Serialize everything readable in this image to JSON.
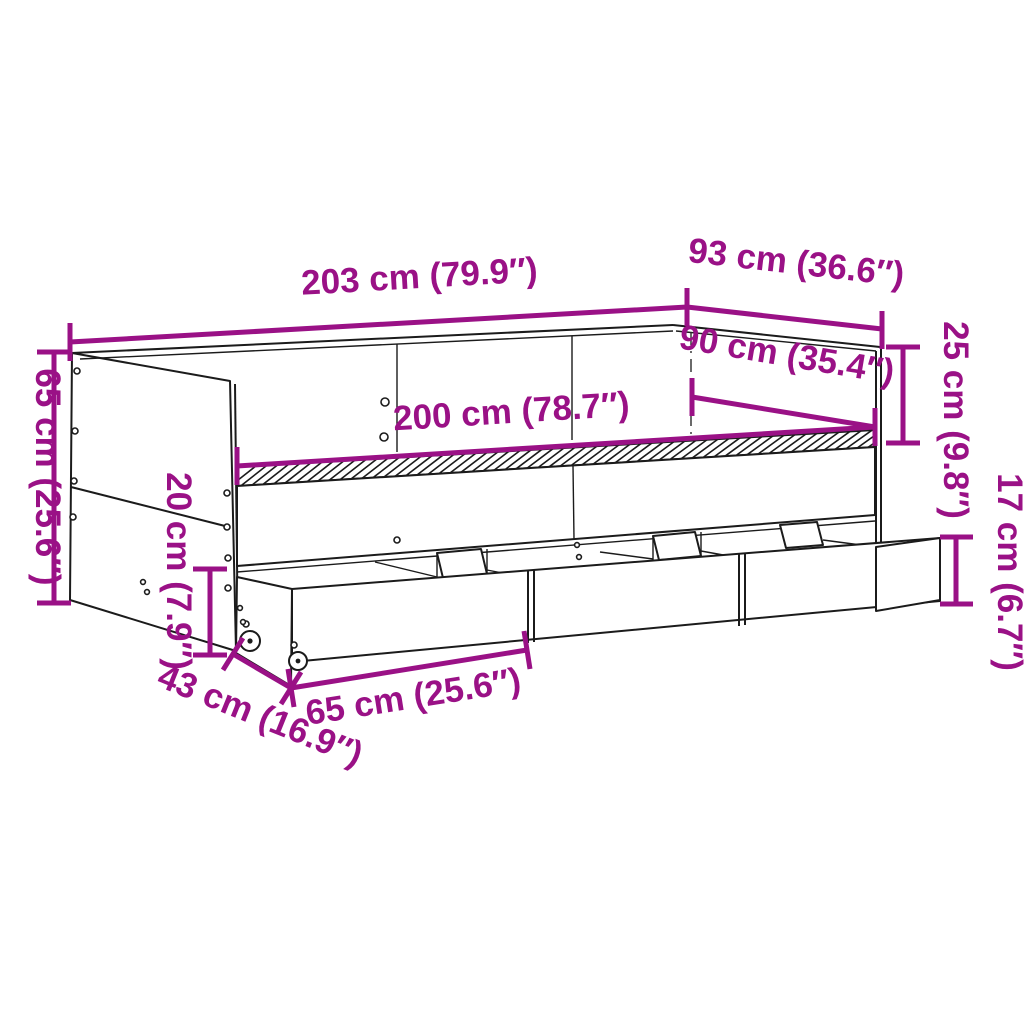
{
  "diagram": {
    "subject": "daybed-with-drawers-dimension-diagram",
    "colors": {
      "dimension_accent": "#9A1186",
      "line_art": "#1b1b1b",
      "background": "#ffffff"
    },
    "dimensions": [
      {
        "id": "overall-length",
        "label": "203 cm (79.9″)",
        "cm": 203,
        "inch": 79.9
      },
      {
        "id": "overall-depth",
        "label": "93 cm (36.6″)",
        "cm": 93,
        "inch": 36.6
      },
      {
        "id": "side-height",
        "label": "65 cm (25.6″)",
        "cm": 65,
        "inch": 25.6
      },
      {
        "id": "backrest-height",
        "label": "25 cm (9.8″)",
        "cm": 25,
        "inch": 9.8
      },
      {
        "id": "inner-width",
        "label": "90 cm (35.4″)",
        "cm": 90,
        "inch": 35.4
      },
      {
        "id": "inner-length",
        "label": "200 cm (78.7″)",
        "cm": 200,
        "inch": 78.7
      },
      {
        "id": "under-clearance",
        "label": "20 cm (7.9″)",
        "cm": 20,
        "inch": 7.9
      },
      {
        "id": "drawer-height",
        "label": "17 cm (6.7″)",
        "cm": 17,
        "inch": 6.7
      },
      {
        "id": "drawer-depth",
        "label": "43 cm (16.9″)",
        "cm": 43,
        "inch": 16.9
      },
      {
        "id": "drawer-width",
        "label": "65 cm (25.6″)",
        "cm": 65,
        "inch": 25.6
      }
    ]
  }
}
